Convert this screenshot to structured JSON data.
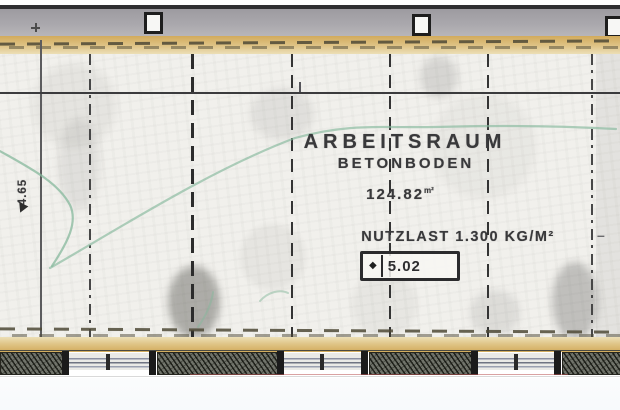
{
  "drawing": {
    "room_label": "ARBEITSRAUM",
    "floor_label": "BETONBODEN",
    "area_value": "124.82",
    "area_unit": "m²",
    "load_label": "NUTZLAST 1.300 KG/M²",
    "elevation_symbol": "◆",
    "elevation_value": "5.02",
    "dim_left": "4.65",
    "stray_dash": "–"
  },
  "colors": {
    "top_band_gray": "#aaa8ad",
    "insulation_tan": "#d2ab5c",
    "marker_green": "#85b89c",
    "wall_dark": "#1b1b1b",
    "paper": "#f1f0ec",
    "ink": "#39393b",
    "window_line_blue": "#8b90a2",
    "faint_red_line": "#b95555"
  }
}
